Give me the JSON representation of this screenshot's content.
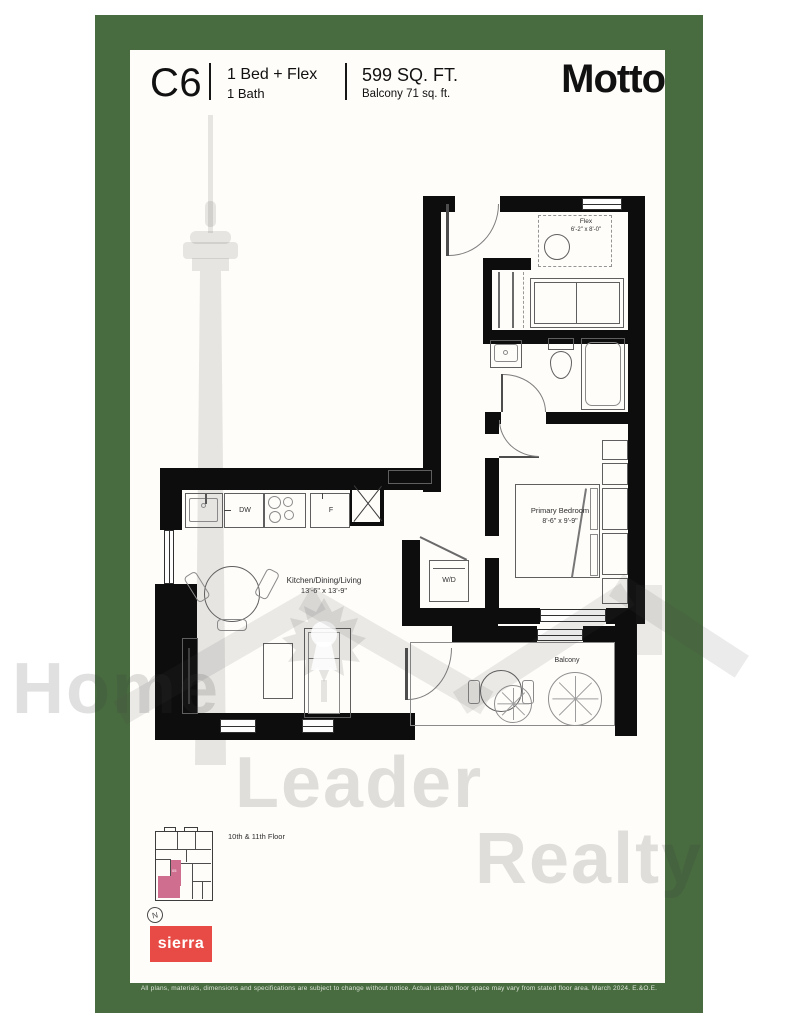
{
  "header": {
    "unit_code": "C6",
    "bed_config": "1 Bed + Flex",
    "bath_config": "1 Bath",
    "area": "599 SQ. FT.",
    "balcony_area": "Balcony 71 sq. ft.",
    "brand": "Motto"
  },
  "plan": {
    "flex": {
      "name": "Flex",
      "dims": "6'-2\" x 8'-0\""
    },
    "kitchen": {
      "name": "Kitchen/Dining/Living",
      "dims": "13'-6\" x 13'-9\""
    },
    "bedroom": {
      "name": "Primary Bedroom",
      "dims": "8'-6\" x 9'-9\""
    },
    "balcony": {
      "name": "Balcony"
    },
    "laundry": {
      "name": "W/D"
    },
    "appliances": {
      "dishwasher": "DW",
      "fridge": "F"
    }
  },
  "keyplan": {
    "caption": "10th & 11th Floor",
    "north": "N",
    "unit_label": "05"
  },
  "footer": {
    "logo": "sierra",
    "disclaimer": "All plans, materials, dimensions and specifications are subject to change without notice. Actual usable floor space may vary from stated floor area. March 2024. E.&O.E."
  },
  "watermark": {
    "word1": "Home",
    "word2": "Leader",
    "word3": "Realty"
  },
  "colors": {
    "frame_green": "#486b40",
    "sierra_red": "#e84b45",
    "keyplan_pink": "#d06e90",
    "watermark_gray": "#dcdcdc",
    "wall_black": "#0d0d0d"
  }
}
